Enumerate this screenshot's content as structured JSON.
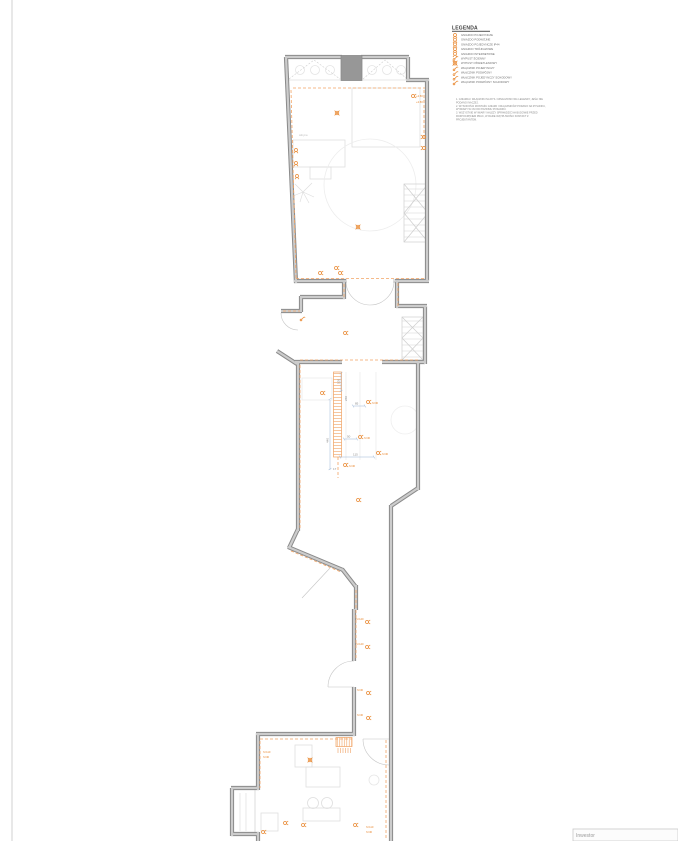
{
  "legend": {
    "title": "LEGENDA",
    "items": [
      {
        "symbol": "socket-single-icon",
        "label": "GNIAZDO POJEDYNCZE"
      },
      {
        "symbol": "socket-double-icon",
        "label": "GNIAZDO PODWÓJNE"
      },
      {
        "symbol": "socket-ip44-icon",
        "label": "GNIAZDO POJEDYNCZE IP44"
      },
      {
        "symbol": "socket-three-phase-icon",
        "label": "GNIAZDO TRÓJFAZOWE"
      },
      {
        "symbol": "socket-internet-icon",
        "label": "GNIAZDO INTERNETOWE"
      },
      {
        "symbol": "wall-outlet-icon",
        "label": "WYPUST ŚCIENNY"
      },
      {
        "symbol": "ceiling-light-icon",
        "label": "WYPUST OŚWIETLENIOWY"
      },
      {
        "symbol": "switch-single-icon",
        "label": "WŁĄCZNIK POJEDYNCZY"
      },
      {
        "symbol": "switch-double-icon",
        "label": "WŁĄCZNIK PODWÓJNY"
      },
      {
        "symbol": "switch-single-stair-icon",
        "label": "WŁĄCZNIK POJEDYNCZY SCHODOWY"
      },
      {
        "symbol": "switch-double-stair-icon",
        "label": "WŁĄCZNIK PODWÓJNY SCHODOWY"
      }
    ],
    "notes": [
      "1. GNIAZDA I WŁĄCZNIKI NA RYS. OZNACZONO WG LEGENDY, JEŚLI NIE",
      "PODANO INACZEJ.",
      "2. WYSOKOŚCI MONTAŻU GNIAZD I WŁĄCZNIKÓW PODANO NA RYSUNKU,",
      "WYMIARY W CM OD POZIOMU POSADZKI.",
      "3. WSZYSTKIE WYMIARY NALEŻY SPRAWDZIĆ NA BUDOWIE PRZED",
      "ROZPOCZĘCIEM PRAC, W RAZIE WĄTPLIWOŚCI KONTAKT Z",
      "PROJEKTANTEM."
    ]
  },
  "plan": {
    "dims": [
      "100",
      "260",
      "85",
      "50",
      "440",
      "115",
      "17"
    ],
    "levels": [
      "+2.50",
      "+2.50"
    ],
    "heights": [
      "h=30",
      "h=30",
      "h=30",
      "h=30",
      "h=140",
      "h=140",
      "h=30",
      "h=30",
      "h=110",
      "h=30",
      "h=110",
      "h=30"
    ],
    "room_labels": [
      "witryna"
    ]
  },
  "titleblock": {
    "label": "Inwestor"
  },
  "colors": {
    "accent_orange": "#e8862d",
    "wiring_orange": "#f2a464",
    "wall_gray": "#8a8a8a",
    "dim_blue": "#7aa7d9"
  }
}
